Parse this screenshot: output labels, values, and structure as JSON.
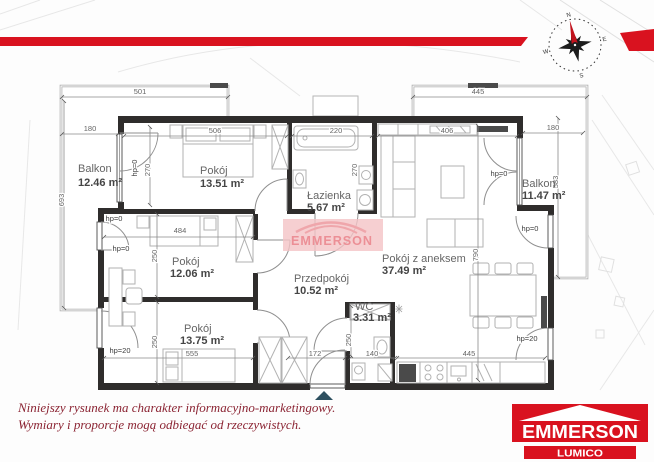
{
  "rooms": {
    "balkon_left": {
      "name": "Balkon",
      "area": "12.46 m²"
    },
    "pokoj1": {
      "name": "Pokój",
      "area": "13.51 m²"
    },
    "lazienka": {
      "name": "Łazienka",
      "area": "5.67 m²"
    },
    "pokoj_aneks": {
      "name": "Pokój z aneksem",
      "area": "37.49 m²"
    },
    "balkon_right": {
      "name": "Balkon",
      "area": "11.47 m²"
    },
    "pokoj2": {
      "name": "Pokój",
      "area": "12.06 m²"
    },
    "przedpokoj": {
      "name": "Przedpokój",
      "area": "10.52 m²"
    },
    "pokoj3": {
      "name": "Pokój",
      "area": "13.75 m²"
    },
    "wc": {
      "name": "WC",
      "area": "3.31 m²"
    }
  },
  "dims": {
    "d501": "501",
    "d445_top": "445",
    "d180_left": "180",
    "d693": "693",
    "d270_left": "270",
    "d506": "506",
    "d220": "220",
    "d270_bath": "270",
    "d406": "406",
    "d180_right": "180",
    "d583": "583",
    "d790": "790",
    "d484": "484",
    "d250_a": "250",
    "d250_b": "250",
    "d555": "555",
    "d172": "172",
    "d140": "140",
    "d445_bottom": "445",
    "d250_wc": "250"
  },
  "marks": {
    "hp0": "hp=0",
    "hp20": "hp=20"
  },
  "compass": {
    "n": "N",
    "e": "E",
    "s": "S",
    "w": "W"
  },
  "watermark": {
    "text": "EMMERSON"
  },
  "footer": {
    "disclaimer_line1": "Niniejszy rysunek ma charakter informacyjno-marketingowy.",
    "disclaimer_line2": "Wymiary i proporcje mogą odbiegać od rzeczywistych.",
    "logo_primary": "EMMERSON",
    "logo_secondary": "LUMICO"
  },
  "colors": {
    "brand_red": "#d9121f",
    "disclaimer_text": "#8b2433",
    "wall": "#2f2d2c",
    "entrance_arrow": "#2d4f5f",
    "watermark_pink": "#f4c3c6"
  }
}
